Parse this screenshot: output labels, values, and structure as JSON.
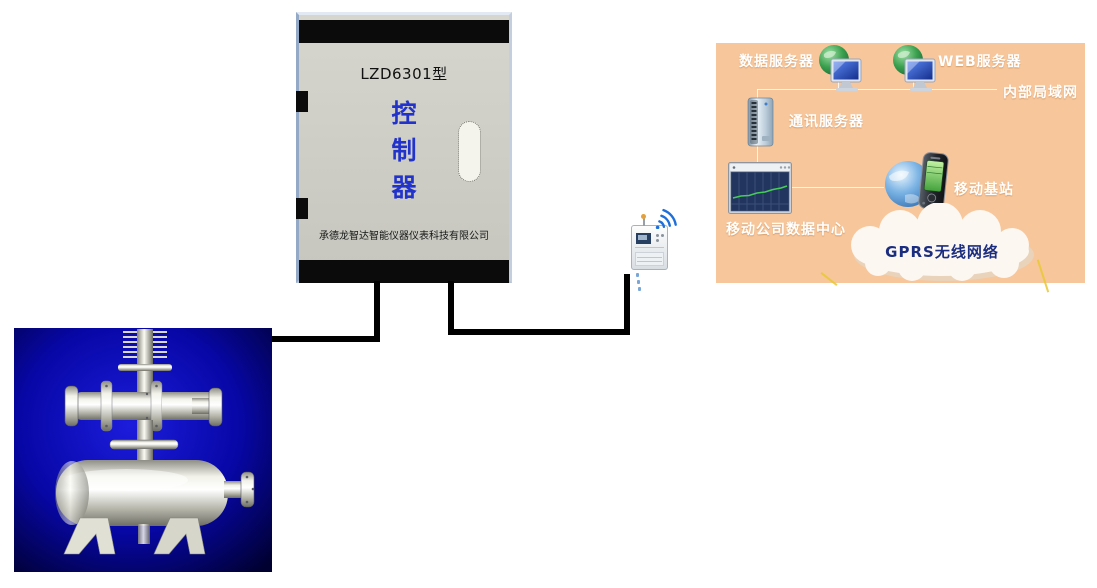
{
  "controller_box": {
    "model": "LZD6301型",
    "label_chars": [
      "控",
      "制",
      "器"
    ],
    "company": "承德龙智达智能仪器仪表科技有限公司",
    "colors": {
      "body": "#d3d3cc",
      "bars": "#0b0b0b",
      "title_blue": "#2233cc"
    }
  },
  "field": {
    "wire_color": "#000000",
    "flow_meter_bg_center": "#1c1cdc",
    "flow_meter_bg_edge": "#000030",
    "wireless_signal_color": "#1e6fd9"
  },
  "network_panel": {
    "bg": "#f7c69b",
    "label_color": "#ffffff",
    "cloud_text_color": "#1b2d80",
    "labels": {
      "data_server": "数据服务器",
      "web_server": "WEB服务器",
      "intranet": "内部局域网",
      "comm_server": "通讯服务器",
      "data_center": "移动公司数据中心",
      "base_station": "移动基站",
      "gprs_cloud": "GPRS无线网络"
    }
  }
}
